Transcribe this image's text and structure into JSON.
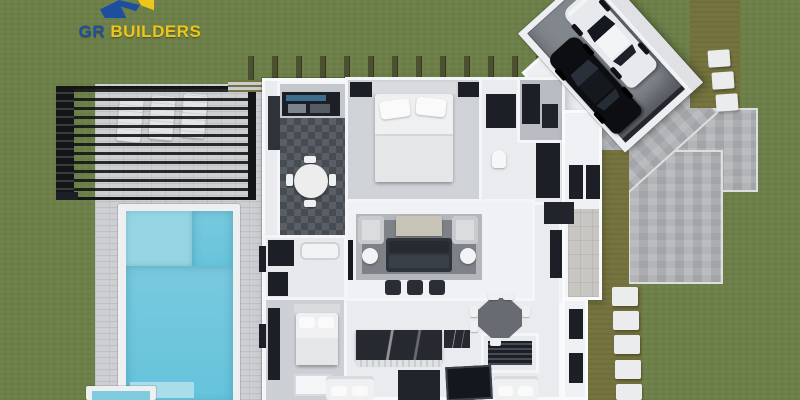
{
  "logo": {
    "brand_primary": "GR",
    "brand_secondary": "BUILDERS",
    "primary_color": "#1d4f9e",
    "secondary_color": "#eec51b"
  },
  "palette": {
    "grass": "#6e8049",
    "olive_grass": "#75743f",
    "deck_paver": "#cdcfd3",
    "driveway_paver": "#b4b6b9",
    "pool_water": "#64c3db",
    "pool_shallow": "#95d5e3",
    "pool_coping": "#edeff1",
    "spa_water": "#7fccde",
    "pergola_frame": "#141517",
    "house_wall": "#f4f6f8",
    "house_floor": "#e9ebef",
    "dark_accent": "#1c2026",
    "stone_white": "#eaecee",
    "porch_stone": "#c7c6c2",
    "white_car": "#e7e9ec",
    "black_car": "#0c0e12"
  }
}
